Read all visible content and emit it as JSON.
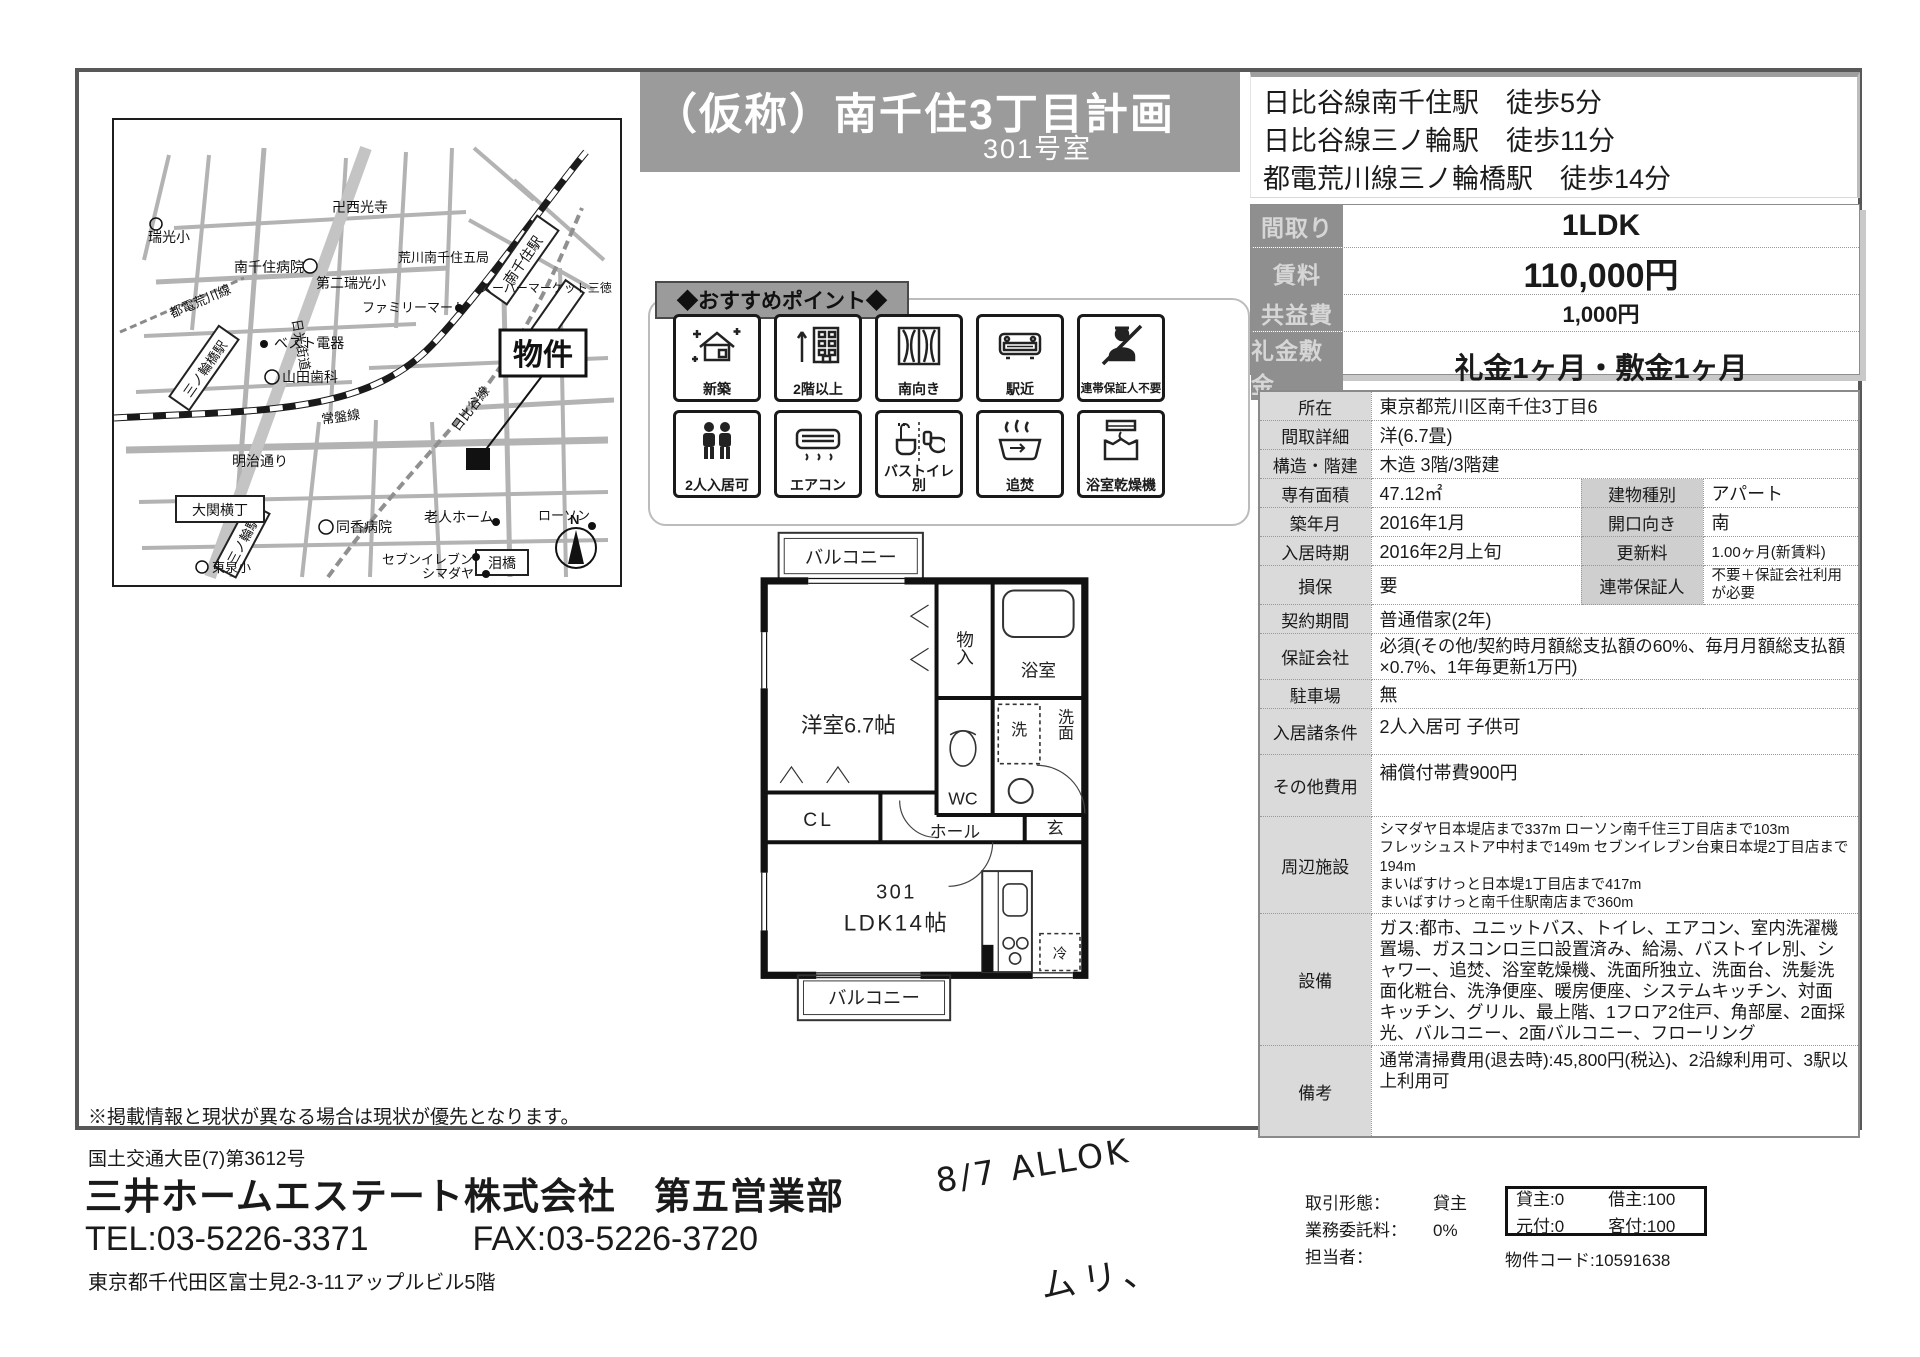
{
  "title": {
    "name": "（仮称）南千住3丁目計画",
    "room": "301号室"
  },
  "access": {
    "lines": [
      "日比谷線南千住駅　徒歩5分",
      "日比谷線三ノ輪駅　徒歩11分",
      "都電荒川線三ノ輪橋駅　徒歩14分"
    ]
  },
  "price_table": {
    "rows": [
      {
        "label": "間取り",
        "value": "1LDK"
      },
      {
        "label": "賃料",
        "value": "110,000円"
      },
      {
        "label": "共益費",
        "value": "1,000円"
      },
      {
        "label": "礼金敷金",
        "value": "礼金1ヶ月・敷金1ヶ月"
      }
    ]
  },
  "detail": {
    "rows": [
      {
        "label": "所在",
        "value": "東京都荒川区南千住3丁目6"
      },
      {
        "label": "間取詳細",
        "value": "洋(6.7畳)"
      },
      {
        "label": "構造・階建",
        "value": "木造 3階/3階建"
      },
      {
        "label": "専有面積",
        "value": "47.12㎡",
        "label2": "建物種別",
        "value2": "アパート"
      },
      {
        "label": "築年月",
        "value": "2016年1月",
        "label2": "開口向き",
        "value2": "南"
      },
      {
        "label": "入居時期",
        "value": "2016年2月上旬",
        "label2": "更新料",
        "value2": "1.00ヶ月(新賃料)"
      },
      {
        "label": "損保",
        "value": "要",
        "label2": "連帯保証人",
        "value2": "不要＋保証会社利用が必要"
      },
      {
        "label": "契約期間",
        "value": "普通借家(2年)"
      },
      {
        "label": "保証会社",
        "value": "必須(その他/契約時月額総支払額の60%、毎月月額総支払額×0.7%、1年毎更新1万円)"
      },
      {
        "label": "駐車場",
        "value": "無"
      },
      {
        "label": "入居諸条件",
        "value": "2人入居可 子供可"
      },
      {
        "label": "その他費用",
        "value": "補償付帯費900円"
      },
      {
        "label": "周辺施設",
        "value": "シマダヤ日本堤店まで337m ローソン南千住三丁目店まで103m\nフレッシュストア中村まで149m セブンイレブン台東日本堤2丁目店まで194m\nまいばすけっと日本堤1丁目店まで417m\nまいばすけっと南千住駅南店まで360m"
      },
      {
        "label": "設備",
        "value": "ガス:都市、ユニットバス、トイレ、エアコン、室内洗濯機置場、ガスコンロ三口設置済み、給湯、バストイレ別、シャワー、追焚、浴室乾燥機、洗面所独立、洗面台、洗髪洗面化粧台、洗浄便座、暖房便座、システムキッチン、対面キッチン、グリル、最上階、1フロア2住戸、角部屋、2面採光、バルコニー、2面バルコニー、フローリング"
      },
      {
        "label": "備考",
        "value": "通常清掃費用(退去時):45,800円(税込)、2沿線利用可、3駅以上利用可"
      }
    ]
  },
  "points": {
    "header": "◆おすすめポイント◆",
    "items": [
      "新築",
      "2階以上",
      "南向き",
      "駅近",
      "連帯保証人不要",
      "2人入居可",
      "エアコン",
      "バストイレ別",
      "追焚",
      "浴室乾燥機"
    ]
  },
  "floorplan": {
    "labels": {
      "balcony_top": "バルコニー",
      "western_room": "洋室6.7帖",
      "storage": "物入",
      "bath": "浴室",
      "washer": "洗",
      "washroom": "洗面",
      "wc": "WC",
      "closet": "CL",
      "hall": "ホール",
      "entrance": "玄",
      "unit": "301",
      "ldk": "LDK14帖",
      "fridge": "冷",
      "balcony_bottom": "バルコニー"
    }
  },
  "map": {
    "property_label": "物件",
    "compass": "N",
    "labels": [
      "瑞光小",
      "卍西光寺",
      "南千住病院",
      "第二瑞光小",
      "荒川南千住五局",
      "スーパーマーケット三徳",
      "ファミリーマート",
      "ベスト電器",
      "山田歯科",
      "常盤線",
      "都電荒川線",
      "三ノ輪橋駅",
      "南千住駅",
      "日比谷線",
      "日光街道",
      "明治通り",
      "大関横丁",
      "三ノ輪駅",
      "同香病院",
      "老人ホーム",
      "ローソン",
      "泪橋",
      "セブンイレブン",
      "シマダヤ",
      "東泉小"
    ]
  },
  "page": {
    "disclaimer": "※掲載情報と現状が異なる場合は現状が優先となります。"
  },
  "company": {
    "license": "国土交通大臣(7)第3612号",
    "name": "三井ホームエステート株式会社　第五営業部",
    "tel": "TEL:03-5226-3371",
    "fax": "FAX:03-5226-3720",
    "address": "東京都千代田区富士見2-3-11アップルビル5階"
  },
  "handwriting": {
    "line1": "8/7  ALLOK",
    "line2": "ムリ、"
  },
  "deal": {
    "rows": [
      {
        "label": "取引形態：",
        "value": "貸主"
      },
      {
        "label": "業務委託料：",
        "value": "0%"
      },
      {
        "label": "担当者：",
        "value": ""
      }
    ],
    "split": {
      "c1": "貸主:0",
      "c2": "借主:100",
      "c3": "元付:0",
      "c4": "客付:100"
    },
    "property_code": "物件コード:10591638"
  }
}
